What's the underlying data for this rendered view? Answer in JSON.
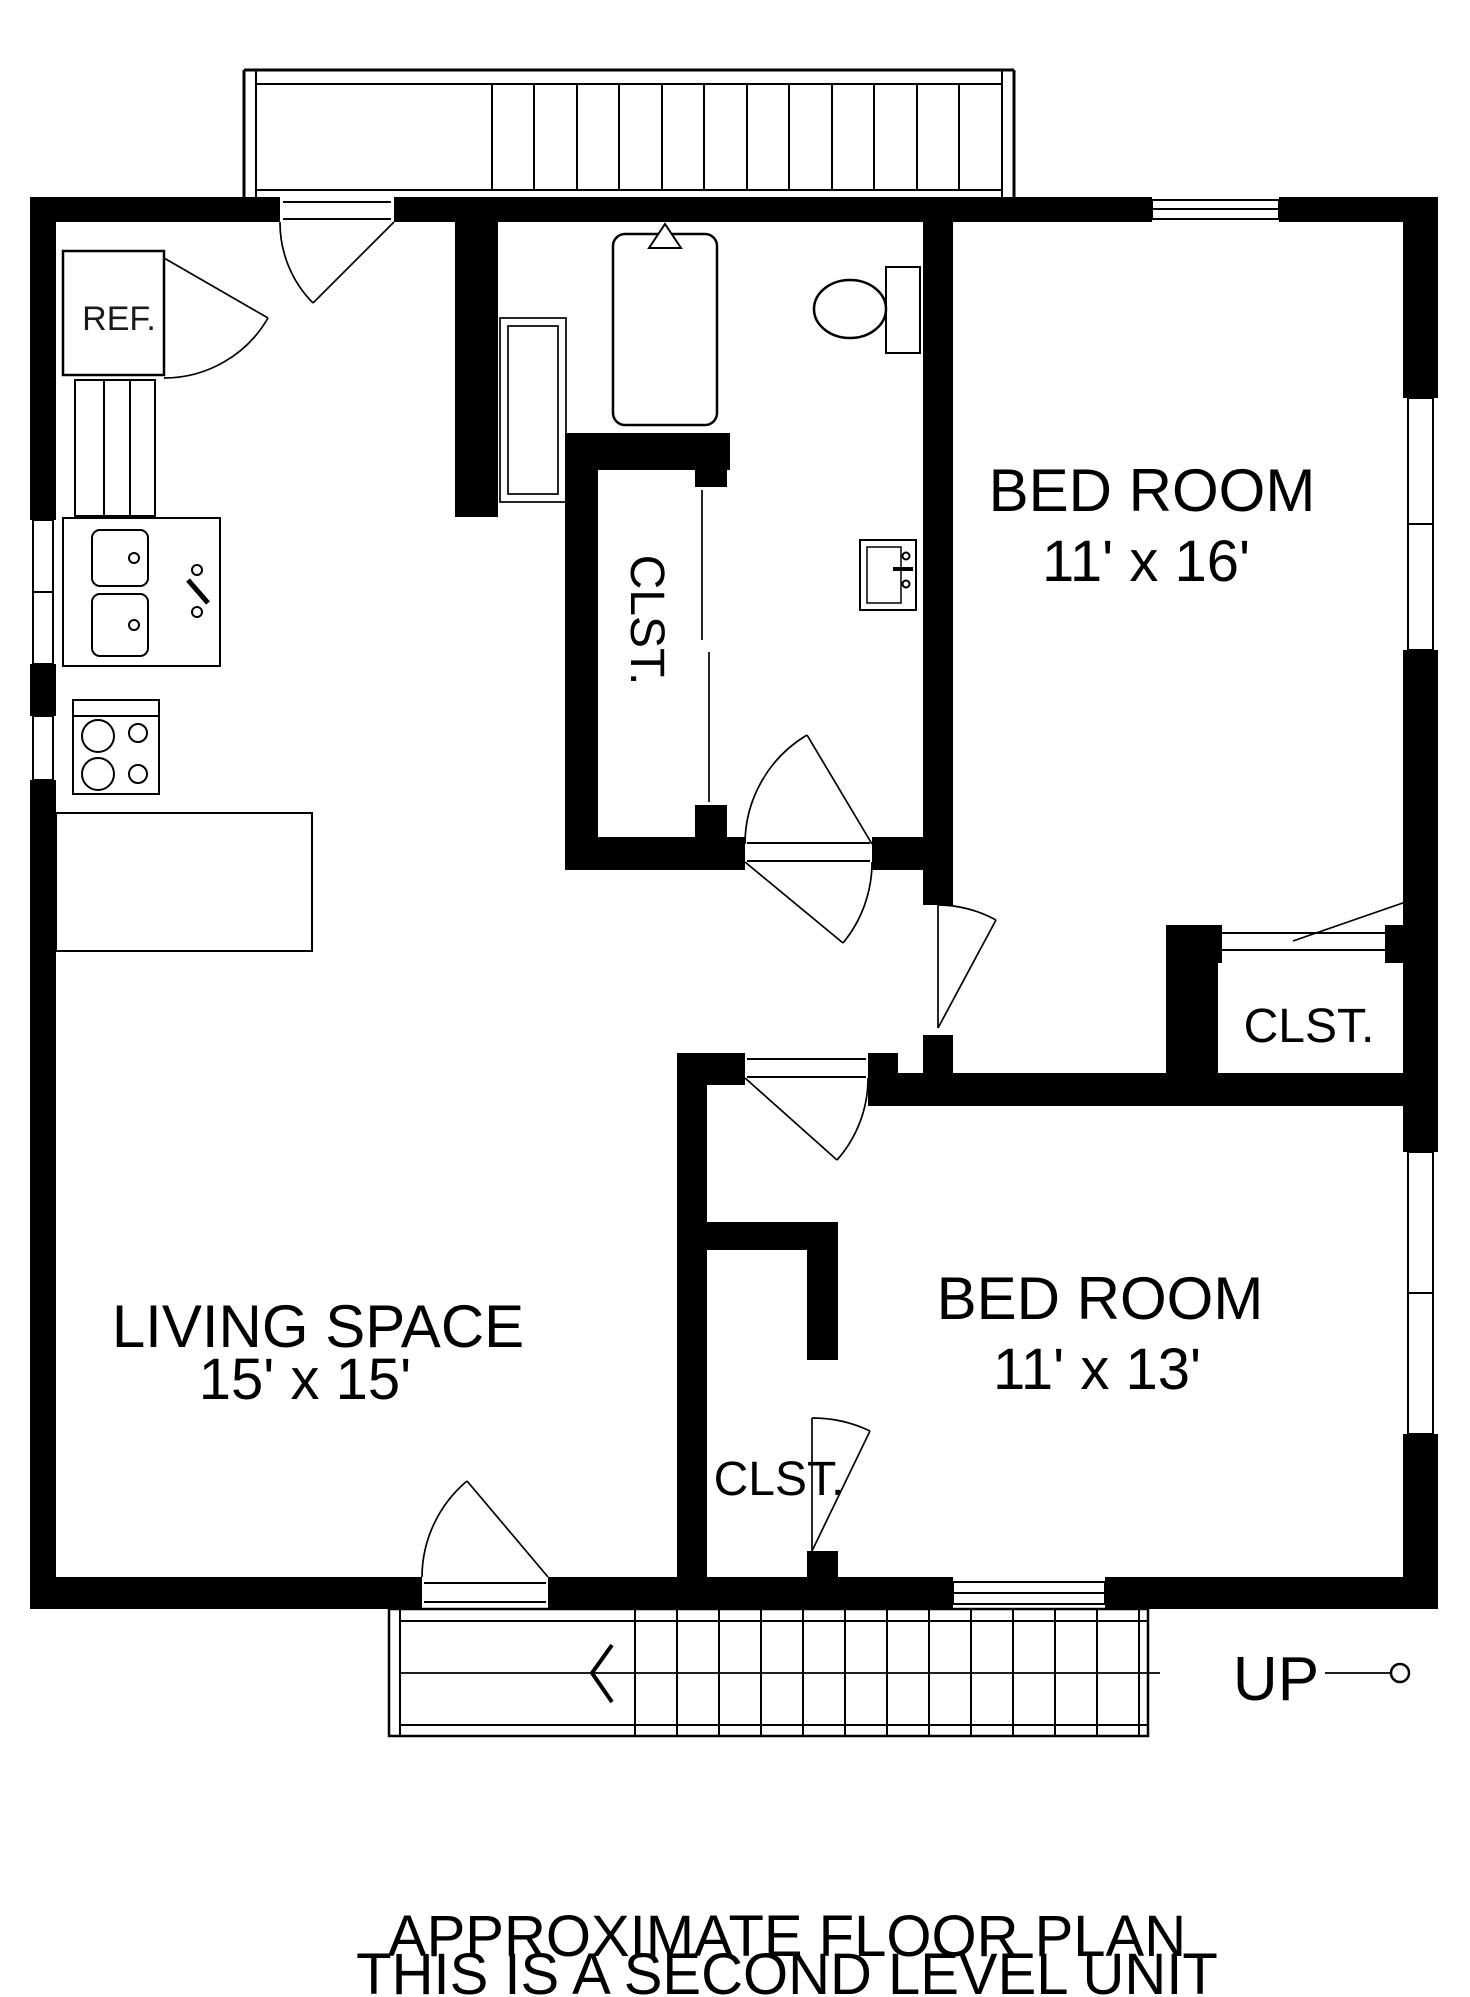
{
  "plan": {
    "footer": {
      "line1": "APPROXIMATE FLOOR PLAN",
      "line2": "THIS IS A SECOND LEVEL UNIT"
    },
    "rooms": {
      "living_space": {
        "name": "LIVING SPACE",
        "dimensions": "15' x 15'"
      },
      "bedroom_1": {
        "name": "BED ROOM",
        "dimensions": "11' x 16'"
      },
      "bedroom_2": {
        "name": "BED ROOM",
        "dimensions": "11' x 13'"
      },
      "hall_closet": {
        "name": "CLST."
      },
      "bedroom_1_closet": {
        "name": "CLST."
      },
      "bedroom_2_closet": {
        "name": "CLST."
      }
    },
    "labels": {
      "refrigerator": "REF.",
      "stairs_up": "UP"
    },
    "colors": {
      "wall": "#000000",
      "background": "#ffffff",
      "line": "#000000"
    }
  }
}
